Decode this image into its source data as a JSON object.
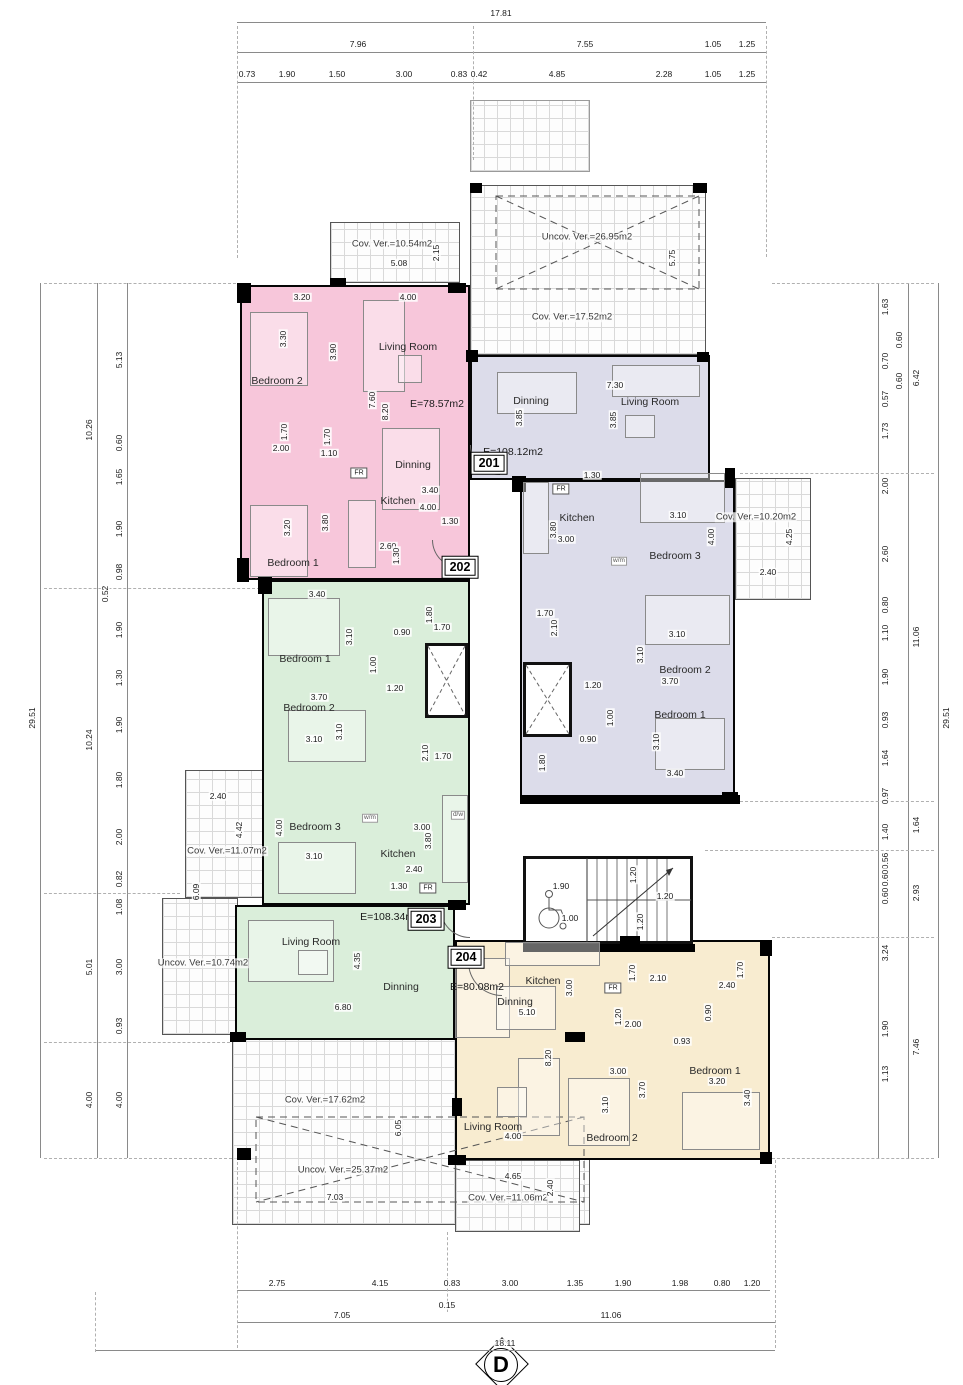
{
  "sheet_marker": "D",
  "apartments": [
    {
      "number": "201",
      "area": "E=108.12m2",
      "color": "#dcdcea"
    },
    {
      "number": "202",
      "area": "E=78.57m2",
      "color": "#f7c6da"
    },
    {
      "number": "203",
      "area": "E=108.34m2",
      "color": "#daeeda"
    },
    {
      "number": "204",
      "area": "E=80.08m2",
      "color": "#f8ecd0"
    }
  ],
  "labels": [
    [
      "17.81",
      501,
      13,
      "d",
      0
    ],
    [
      "7.96",
      358,
      44,
      "d",
      0
    ],
    [
      "7.55",
      585,
      44,
      "d",
      0
    ],
    [
      "1.05",
      713,
      44,
      "d",
      0
    ],
    [
      "1.25",
      747,
      44,
      "d",
      0
    ],
    [
      "0.73",
      247,
      74,
      "d",
      0
    ],
    [
      "1.90",
      287,
      74,
      "d",
      0
    ],
    [
      "1.50",
      337,
      74,
      "d",
      0
    ],
    [
      "3.00",
      404,
      74,
      "d",
      0
    ],
    [
      "0.83",
      459,
      74,
      "d",
      0
    ],
    [
      "0.42",
      479,
      74,
      "d",
      0
    ],
    [
      "4.85",
      557,
      74,
      "d",
      0
    ],
    [
      "2.28",
      664,
      74,
      "d",
      0
    ],
    [
      "1.05",
      713,
      74,
      "d",
      0
    ],
    [
      "1.25",
      747,
      74,
      "d",
      0
    ],
    [
      "29.51",
      32,
      718,
      "d",
      1
    ],
    [
      "10.26",
      89,
      430,
      "d",
      1
    ],
    [
      "10.24",
      89,
      740,
      "d",
      1
    ],
    [
      "5.01",
      89,
      967,
      "d",
      1
    ],
    [
      "4.00",
      89,
      1100,
      "d",
      1
    ],
    [
      "5.13",
      119,
      360,
      "d",
      1
    ],
    [
      "0.60",
      119,
      443,
      "d",
      1
    ],
    [
      "1.65",
      119,
      477,
      "d",
      1
    ],
    [
      "1.90",
      119,
      529,
      "d",
      1
    ],
    [
      "0.98",
      119,
      572,
      "d",
      1
    ],
    [
      "0.52",
      105,
      594,
      "d",
      1
    ],
    [
      "1.90",
      119,
      630,
      "d",
      1
    ],
    [
      "1.30",
      119,
      678,
      "d",
      1
    ],
    [
      "1.90",
      119,
      725,
      "d",
      1
    ],
    [
      "1.80",
      119,
      780,
      "d",
      1
    ],
    [
      "2.00",
      119,
      837,
      "d",
      1
    ],
    [
      "0.82",
      119,
      879,
      "d",
      1
    ],
    [
      "1.08",
      119,
      907,
      "d",
      1
    ],
    [
      "3.00",
      119,
      967,
      "d",
      1
    ],
    [
      "0.93",
      119,
      1026,
      "d",
      1
    ],
    [
      "4.00",
      119,
      1100,
      "d",
      1
    ],
    [
      "29.51",
      946,
      718,
      "d",
      1
    ],
    [
      "6.42",
      916,
      378,
      "d",
      1
    ],
    [
      "11.06",
      916,
      637,
      "d",
      1
    ],
    [
      "1.64",
      916,
      825,
      "d",
      1
    ],
    [
      "2.93",
      916,
      893,
      "d",
      1
    ],
    [
      "7.46",
      916,
      1047,
      "d",
      1
    ],
    [
      "1.63",
      885,
      307,
      "d",
      1
    ],
    [
      "0.60",
      899,
      340,
      "d",
      1
    ],
    [
      "0.70",
      885,
      361,
      "d",
      1
    ],
    [
      "0.60",
      899,
      381,
      "d",
      1
    ],
    [
      "0.57",
      885,
      399,
      "d",
      1
    ],
    [
      "1.73",
      885,
      431,
      "d",
      1
    ],
    [
      "2.00",
      885,
      486,
      "d",
      1
    ],
    [
      "2.60",
      885,
      554,
      "d",
      1
    ],
    [
      "0.80",
      885,
      605,
      "d",
      1
    ],
    [
      "1.10",
      885,
      633,
      "d",
      1
    ],
    [
      "1.90",
      885,
      677,
      "d",
      1
    ],
    [
      "0.93",
      885,
      720,
      "d",
      1
    ],
    [
      "1.64",
      885,
      758,
      "d",
      1
    ],
    [
      "0.97",
      885,
      796,
      "d",
      1
    ],
    [
      "1.40",
      885,
      832,
      "d",
      1
    ],
    [
      "0.56",
      885,
      861,
      "d",
      1
    ],
    [
      "0.60",
      885,
      878,
      "d",
      1
    ],
    [
      "0.60",
      885,
      896,
      "d",
      1
    ],
    [
      "3.24",
      885,
      953,
      "d",
      1
    ],
    [
      "1.90",
      885,
      1029,
      "d",
      1
    ],
    [
      "1.13",
      885,
      1074,
      "d",
      1
    ],
    [
      "2.75",
      277,
      1283,
      "d",
      0
    ],
    [
      "4.15",
      380,
      1283,
      "d",
      0
    ],
    [
      "0.83",
      452,
      1283,
      "d",
      0
    ],
    [
      "3.00",
      510,
      1283,
      "d",
      0
    ],
    [
      "1.35",
      575,
      1283,
      "d",
      0
    ],
    [
      "1.90",
      623,
      1283,
      "d",
      0
    ],
    [
      "1.98",
      680,
      1283,
      "d",
      0
    ],
    [
      "0.80",
      722,
      1283,
      "d",
      0
    ],
    [
      "1.20",
      752,
      1283,
      "d",
      0
    ],
    [
      "0.15",
      447,
      1305,
      "d",
      0
    ],
    [
      "7.05",
      342,
      1315,
      "d",
      0
    ],
    [
      "11.06",
      611,
      1315,
      "d",
      0
    ],
    [
      "18.11",
      505,
      1343,
      "d",
      0
    ],
    [
      "Living Room",
      408,
      347,
      "r",
      0
    ],
    [
      "Bedroom 2",
      277,
      381,
      "r",
      0
    ],
    [
      "Bedroom 1",
      293,
      563,
      "r",
      0
    ],
    [
      "Dinning",
      413,
      465,
      "r",
      0
    ],
    [
      "Kitchen",
      398,
      501,
      "r",
      0
    ],
    [
      "E=78.57m2",
      437,
      404,
      "a",
      0
    ],
    [
      "202",
      460,
      567,
      "b",
      0
    ],
    [
      "FR",
      359,
      473,
      "f",
      0
    ],
    [
      "3.20",
      302,
      297,
      "d",
      0
    ],
    [
      "4.00",
      408,
      297,
      "d",
      0
    ],
    [
      "3.30",
      283,
      339,
      "d",
      1
    ],
    [
      "3.90",
      333,
      352,
      "d",
      1
    ],
    [
      "7.60",
      372,
      400,
      "d",
      1
    ],
    [
      "8.20",
      385,
      412,
      "d",
      1
    ],
    [
      "1.70",
      284,
      432,
      "d",
      1
    ],
    [
      "2.00",
      281,
      448,
      "d",
      0
    ],
    [
      "1.70",
      327,
      437,
      "d",
      1
    ],
    [
      "1.10",
      329,
      453,
      "d",
      0
    ],
    [
      "3.40",
      430,
      490,
      "d",
      0
    ],
    [
      "4.00",
      428,
      507,
      "d",
      0
    ],
    [
      "1.30",
      450,
      521,
      "d",
      0
    ],
    [
      "2.60",
      388,
      546,
      "d",
      0
    ],
    [
      "1.30",
      396,
      556,
      "d",
      1
    ],
    [
      "3.20",
      287,
      528,
      "d",
      1
    ],
    [
      "3.80",
      325,
      523,
      "d",
      1
    ],
    [
      "Dinning",
      531,
      401,
      "r",
      0
    ],
    [
      "Living Room",
      650,
      402,
      "r",
      0
    ],
    [
      "Kitchen",
      577,
      518,
      "r",
      0
    ],
    [
      "Bedroom 3",
      675,
      556,
      "r",
      0
    ],
    [
      "Bedroom 2",
      685,
      670,
      "r",
      0
    ],
    [
      "Bedroom 1",
      680,
      715,
      "r",
      0
    ],
    [
      "E=108.12m2",
      513,
      452,
      "a",
      0
    ],
    [
      "201",
      489,
      463,
      "b",
      0
    ],
    [
      "FR",
      561,
      489,
      "f",
      0
    ],
    [
      "w/m",
      619,
      561,
      "t",
      0
    ],
    [
      "7.30",
      615,
      385,
      "d",
      0
    ],
    [
      "3.85",
      519,
      418,
      "d",
      1
    ],
    [
      "3.85",
      613,
      420,
      "d",
      1
    ],
    [
      "1.30",
      592,
      475,
      "d",
      0
    ],
    [
      "3.80",
      553,
      530,
      "d",
      1
    ],
    [
      "3.00",
      566,
      539,
      "d",
      0
    ],
    [
      "3.10",
      678,
      515,
      "d",
      0
    ],
    [
      "4.00",
      711,
      537,
      "d",
      1
    ],
    [
      "1.70",
      545,
      613,
      "d",
      0
    ],
    [
      "2.10",
      554,
      628,
      "d",
      1
    ],
    [
      "3.10",
      677,
      634,
      "d",
      0
    ],
    [
      "3.10",
      640,
      655,
      "d",
      1
    ],
    [
      "3.70",
      670,
      681,
      "d",
      0
    ],
    [
      "1.20",
      593,
      685,
      "d",
      0
    ],
    [
      "1.00",
      610,
      718,
      "d",
      1
    ],
    [
      "0.90",
      588,
      739,
      "d",
      0
    ],
    [
      "3.10",
      656,
      742,
      "d",
      1
    ],
    [
      "1.80",
      542,
      763,
      "d",
      1
    ],
    [
      "3.40",
      675,
      773,
      "d",
      0
    ],
    [
      "Bedroom 1",
      305,
      659,
      "r",
      0
    ],
    [
      "Bedroom 2",
      309,
      708,
      "r",
      0
    ],
    [
      "Bedroom 3",
      315,
      827,
      "r",
      0
    ],
    [
      "Kitchen",
      398,
      854,
      "r",
      0
    ],
    [
      "Living Room",
      311,
      942,
      "r",
      0
    ],
    [
      "Dinning",
      401,
      987,
      "r",
      0
    ],
    [
      "E=108.34m2",
      390,
      917,
      "a",
      0
    ],
    [
      "203",
      426,
      919,
      "b",
      0
    ],
    [
      "FR",
      428,
      888,
      "f",
      0
    ],
    [
      "w/m",
      370,
      818,
      "t",
      0
    ],
    [
      "d/w",
      458,
      815,
      "t",
      0
    ],
    [
      "3.40",
      317,
      594,
      "d",
      0
    ],
    [
      "3.10",
      349,
      637,
      "d",
      1
    ],
    [
      "1.80",
      429,
      615,
      "d",
      1
    ],
    [
      "0.90",
      402,
      632,
      "d",
      0
    ],
    [
      "1.70",
      442,
      627,
      "d",
      0
    ],
    [
      "1.00",
      373,
      665,
      "d",
      1
    ],
    [
      "1.20",
      395,
      688,
      "d",
      0
    ],
    [
      "3.70",
      319,
      697,
      "d",
      0
    ],
    [
      "3.10",
      339,
      732,
      "d",
      1
    ],
    [
      "3.10",
      314,
      739,
      "d",
      0
    ],
    [
      "2.10",
      425,
      753,
      "d",
      1
    ],
    [
      "1.70",
      443,
      756,
      "d",
      0
    ],
    [
      "4.00",
      279,
      828,
      "d",
      1
    ],
    [
      "3.00",
      422,
      827,
      "d",
      0
    ],
    [
      "3.80",
      428,
      841,
      "d",
      1
    ],
    [
      "3.10",
      314,
      856,
      "d",
      0
    ],
    [
      "2.40",
      414,
      869,
      "d",
      0
    ],
    [
      "1.30",
      399,
      886,
      "d",
      0
    ],
    [
      "4.35",
      357,
      961,
      "d",
      1
    ],
    [
      "6.80",
      343,
      1007,
      "d",
      0
    ],
    [
      "Kitchen",
      543,
      981,
      "r",
      0
    ],
    [
      "Dinning",
      515,
      1002,
      "r",
      0
    ],
    [
      "Bedroom 1",
      715,
      1071,
      "r",
      0
    ],
    [
      "Bedroom 2",
      612,
      1138,
      "r",
      0
    ],
    [
      "Living Room",
      493,
      1127,
      "r",
      0
    ],
    [
      "E=80.08m2",
      477,
      987,
      "a",
      0
    ],
    [
      "204",
      466,
      957,
      "b",
      0
    ],
    [
      "FR",
      613,
      988,
      "f",
      0
    ],
    [
      "3.00",
      569,
      988,
      "d",
      1
    ],
    [
      "5.10",
      527,
      1012,
      "d",
      0
    ],
    [
      "1.70",
      632,
      973,
      "d",
      1
    ],
    [
      "2.10",
      658,
      978,
      "d",
      0
    ],
    [
      "2.40",
      727,
      985,
      "d",
      0
    ],
    [
      "1.70",
      740,
      970,
      "d",
      1
    ],
    [
      "0.90",
      708,
      1013,
      "d",
      1
    ],
    [
      "1.20",
      618,
      1017,
      "d",
      1
    ],
    [
      "2.00",
      633,
      1024,
      "d",
      0
    ],
    [
      "0.93",
      682,
      1041,
      "d",
      0
    ],
    [
      "8.20",
      548,
      1058,
      "d",
      1
    ],
    [
      "3.00",
      618,
      1071,
      "d",
      0
    ],
    [
      "3.20",
      717,
      1081,
      "d",
      0
    ],
    [
      "3.70",
      642,
      1090,
      "d",
      1
    ],
    [
      "3.10",
      605,
      1105,
      "d",
      1
    ],
    [
      "3.40",
      747,
      1098,
      "d",
      1
    ],
    [
      "4.00",
      513,
      1136,
      "d",
      0
    ],
    [
      "Cov. Ver.=10.54m2",
      392,
      244,
      "v",
      0
    ],
    [
      "5.08",
      399,
      263,
      "d",
      0
    ],
    [
      "2.15",
      436,
      253,
      "d",
      1
    ],
    [
      "Uncov. Ver.=26.95m2",
      587,
      237,
      "v",
      0
    ],
    [
      "5.75",
      672,
      258,
      "d",
      1
    ],
    [
      "Cov. Ver.=17.52m2",
      572,
      317,
      "v",
      0
    ],
    [
      "Cov. Ver.=10.20m2",
      756,
      517,
      "v",
      0
    ],
    [
      "4.25",
      789,
      537,
      "d",
      1
    ],
    [
      "2.40",
      768,
      572,
      "d",
      0
    ],
    [
      "2.40",
      218,
      796,
      "d",
      0
    ],
    [
      "4.42",
      239,
      830,
      "d",
      1
    ],
    [
      "Cov. Ver.=11.07m2",
      227,
      851,
      "v",
      0
    ],
    [
      "6.09",
      196,
      892,
      "d",
      1
    ],
    [
      "Uncov. Ver.=10.74m2",
      203,
      963,
      "v",
      0
    ],
    [
      "Cov. Ver.=17.62m2",
      325,
      1100,
      "v",
      0
    ],
    [
      "6.05",
      398,
      1128,
      "d",
      1
    ],
    [
      "Uncov. Ver.=25.37m2",
      343,
      1170,
      "v",
      0
    ],
    [
      "7.03",
      335,
      1197,
      "d",
      0
    ],
    [
      "4.65",
      513,
      1176,
      "d",
      0
    ],
    [
      "Cov. Ver.=11.06m2",
      508,
      1198,
      "v",
      0
    ],
    [
      "2.40",
      550,
      1188,
      "d",
      1
    ],
    [
      "1.90",
      561,
      886,
      "d",
      0
    ],
    [
      "1.00",
      570,
      918,
      "d",
      0
    ],
    [
      "1.20",
      633,
      875,
      "d",
      1
    ],
    [
      "1.20",
      665,
      896,
      "d",
      0
    ],
    [
      "1.20",
      640,
      922,
      "d",
      1
    ]
  ]
}
